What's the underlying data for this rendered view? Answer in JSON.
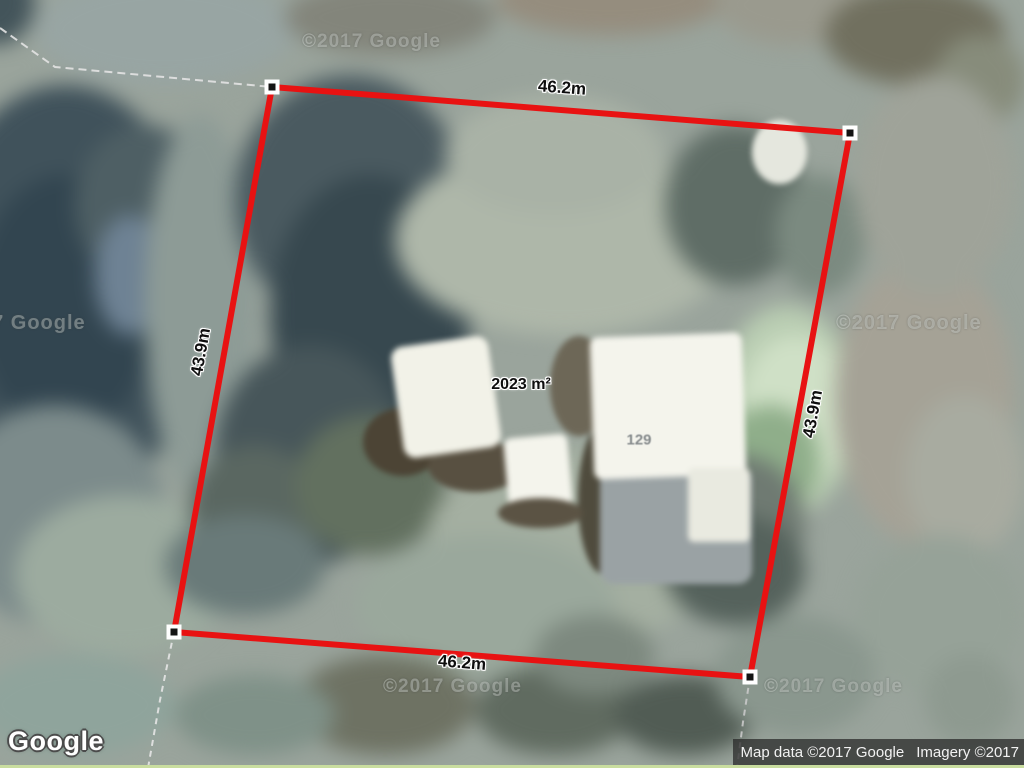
{
  "map": {
    "logo": "Google",
    "attribution_map_data": "Map data ©2017 Google",
    "attribution_imagery": "Imagery ©2017",
    "watermark": "©2017 Google",
    "parcel": {
      "area": "2023 m²",
      "house_number": "129",
      "width_top": "46.2m",
      "width_bottom": "46.2m",
      "height_left": "43.9m",
      "height_right": "43.9m",
      "boundary_color": "#e81212"
    }
  }
}
